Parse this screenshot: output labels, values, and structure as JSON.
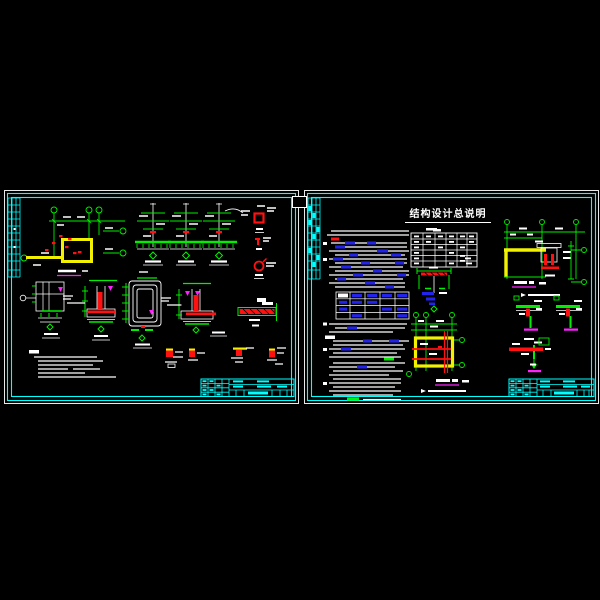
{
  "canvas": {
    "width": 600,
    "height": 600,
    "background": "#000000"
  },
  "palette": {
    "frame_white": "#e9e9e9",
    "border_cyan": "#00ffff",
    "line_green": "#00ef00",
    "line_white": "#ffffff",
    "line_red": "#ff1111",
    "wall_yellow": "#f2f200",
    "caption_magenta": "#ff22ff",
    "highlight_blue": "#2323ee"
  },
  "left_sheet": {
    "description": "detail-drawings-sheet"
  },
  "right_sheet": {
    "title": "结构设计总说明"
  }
}
